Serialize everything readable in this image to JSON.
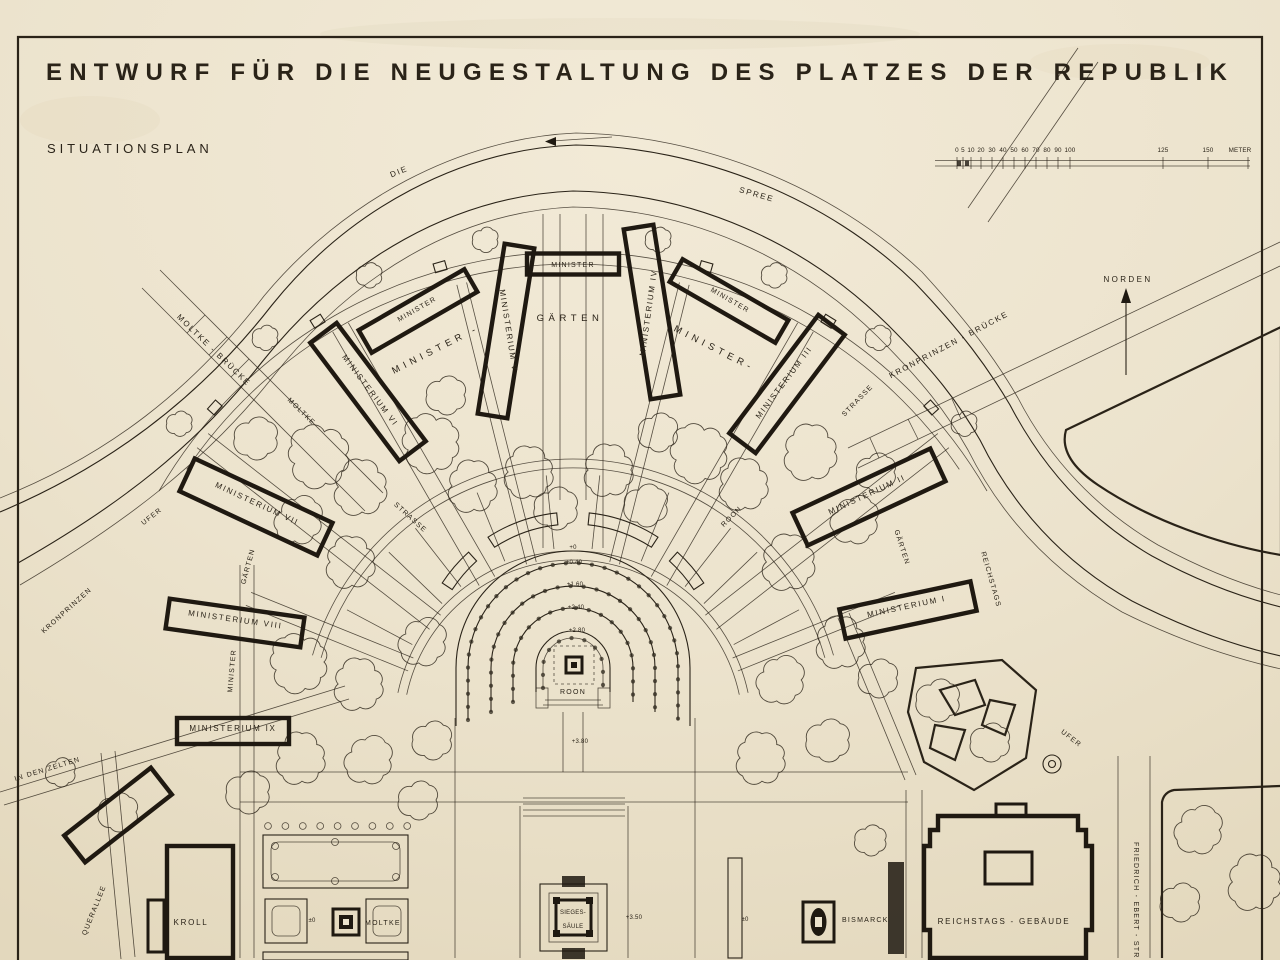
{
  "colors": {
    "paper": "#ece3cd",
    "ink": "#2a2318"
  },
  "header": {
    "title": "ENTWURF FÜR DIE NEUGESTALTUNG DES PLATZES DER REPUBLIK",
    "subtitle": "SITUATIONSPLAN"
  },
  "compass": {
    "label": "NORDEN"
  },
  "scale_bar": {
    "ticks": [
      "0",
      "5",
      "10",
      "20",
      "30",
      "40",
      "50",
      "60",
      "70",
      "80",
      "90",
      "100",
      "125",
      "150"
    ],
    "unit": "METER"
  },
  "river": {
    "name_part1": "DIE",
    "name_part2": "SPREE"
  },
  "bridges": {
    "moltke": "MOLTKE - BRÜCKE",
    "kronprinzen": "KRONPRINZEN - BRÜCKE"
  },
  "streets": {
    "moltke": "MOLTKE",
    "strasse_west": "STRASSE",
    "strasse_east": "STRASSE",
    "roon": "ROON",
    "ufer_west": "UFER",
    "kronprinzen_ufer": "KRONPRINZEN",
    "in_den_zelten": "IN DEN ZELTEN",
    "querallee": "QUERALLEE",
    "minister_west": "MINISTER",
    "reichstags_ufer": "REICHSTAGS",
    "ufer_east": "UFER",
    "friedrich_ebert": "FRIEDRICH - EBERT - STR"
  },
  "ministries": {
    "m1": "MINISTERIUM I",
    "m2": "MINISTERIUM II",
    "m3": "MINISTERIUM III",
    "m4": "MINISTERIUM IV",
    "m5": "MINISTERIUM V",
    "m6": "MINISTERIUM VI",
    "m7": "MINISTERIUM VII",
    "m8": "MINISTERIUM VIII",
    "m9": "MINISTERIUM IX",
    "minister_nw": "MINISTER",
    "minister_n": "MINISTER",
    "minister_ne": "MINISTER"
  },
  "gardens": {
    "minister_west": "MINISTER -",
    "gaerten_north": "GÄRTEN",
    "minister_east": "MINISTER-",
    "gaerten_west": "GÄRTEN",
    "gaerten_east": "GÄRTEN"
  },
  "buildings": {
    "kroll": "KROLL",
    "reichstag": "REICHSTAGS - GEBÄUDE"
  },
  "monuments": {
    "moltke": "MOLTKE",
    "bismarck": "BISMARCK",
    "sieges_line1": "SIEGES-",
    "sieges_line2": "SÄULE",
    "roon": "ROON"
  },
  "levels": {
    "axis_0": "+0",
    "axis_040": "+0.40",
    "axis_160": "+1.60",
    "axis_240": "+2.40",
    "axis_280": "+2.80",
    "axis_380": "+3.80",
    "sieges": "+3.50",
    "moltke": "±0",
    "bismarck": "±0"
  }
}
